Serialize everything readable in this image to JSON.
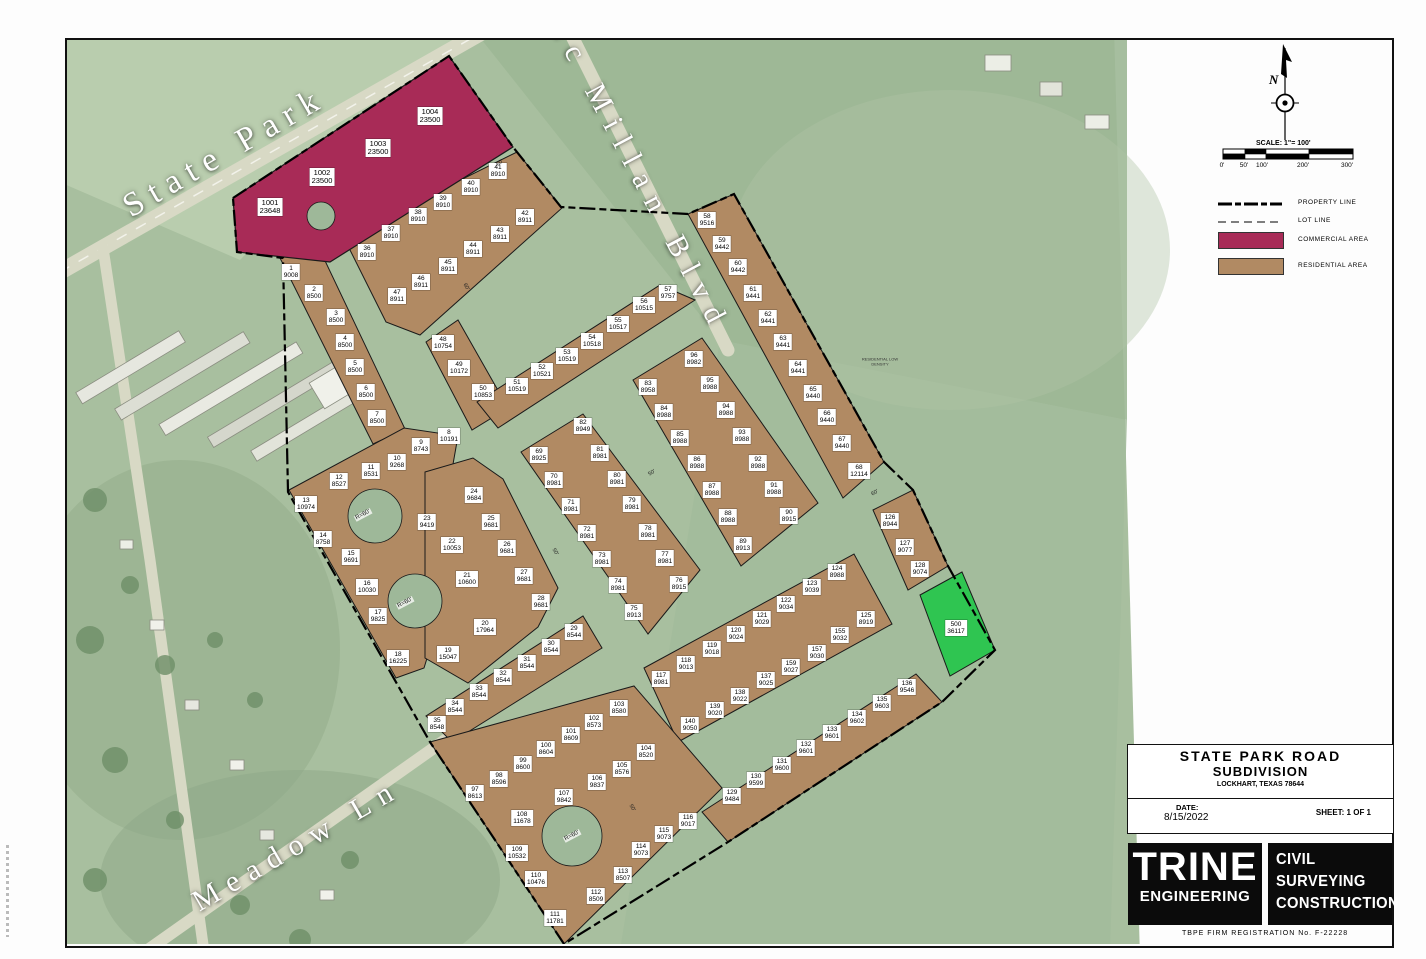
{
  "title_block": {
    "line1": "STATE PARK ROAD",
    "line2": "SUBDIVISION",
    "line3": "LOCKHART, TEXAS 78644",
    "date_label": "DATE:",
    "date": "8/15/2022",
    "sheet": "SHEET: 1 OF 1",
    "firm_name": "TRINE",
    "firm_sub": "ENGINEERING",
    "services": [
      "CIVIL",
      "SURVEYING",
      "CONSTRUCTION"
    ],
    "tbpe": "TBPE FIRM REGISTRATION No. F-22228"
  },
  "legend": {
    "north": "N",
    "scale_label": "SCALE: 1\"= 100'",
    "ticks": [
      "0'",
      "50'",
      "100'",
      "200'",
      "300'"
    ],
    "items": [
      {
        "key": "property-line",
        "label": "PROPERTY LINE"
      },
      {
        "key": "lot-line",
        "label": "LOT LINE"
      },
      {
        "key": "commercial",
        "label": "COMMERCIAL AREA"
      },
      {
        "key": "residential",
        "label": "RESIDENTIAL AREA"
      }
    ]
  },
  "streets": [
    {
      "name": "State Park"
    },
    {
      "name": "Mc Millan Blvd"
    },
    {
      "name": "Meadow Ln"
    }
  ],
  "colors": {
    "commercial": "#a82b57",
    "residential": "#b18a63",
    "green": "#2fc551",
    "street": "#9eb899",
    "aerial": "#a8bf9f",
    "road": "#d8d9c5"
  },
  "annotation": "RESIDENTIAL LOW DENSITY",
  "lots": {
    "commercial": [
      {
        "n": "1001",
        "a": "23648",
        "x": 270,
        "y": 207
      },
      {
        "n": "1002",
        "a": "23500",
        "x": 322,
        "y": 177
      },
      {
        "n": "1003",
        "a": "23500",
        "x": 378,
        "y": 148
      },
      {
        "n": "1004",
        "a": "23500",
        "x": 430,
        "y": 116
      }
    ],
    "green": [
      {
        "n": "500",
        "a": "36117",
        "x": 956,
        "y": 628
      }
    ],
    "residential": [
      {
        "n": "1",
        "a": "9008",
        "x": 291,
        "y": 272
      },
      {
        "n": "2",
        "a": "8500",
        "x": 314,
        "y": 293
      },
      {
        "n": "3",
        "a": "8500",
        "x": 336,
        "y": 317
      },
      {
        "n": "4",
        "a": "8500",
        "x": 345,
        "y": 342
      },
      {
        "n": "5",
        "a": "8500",
        "x": 355,
        "y": 367
      },
      {
        "n": "6",
        "a": "8500",
        "x": 366,
        "y": 392
      },
      {
        "n": "7",
        "a": "8500",
        "x": 377,
        "y": 418
      },
      {
        "n": "8",
        "a": "10191",
        "x": 449,
        "y": 436
      },
      {
        "n": "9",
        "a": "8743",
        "x": 421,
        "y": 446
      },
      {
        "n": "10",
        "a": "9268",
        "x": 397,
        "y": 462
      },
      {
        "n": "11",
        "a": "8531",
        "x": 371,
        "y": 471
      },
      {
        "n": "12",
        "a": "8527",
        "x": 339,
        "y": 481
      },
      {
        "n": "13",
        "a": "10974",
        "x": 306,
        "y": 504
      },
      {
        "n": "14",
        "a": "8758",
        "x": 323,
        "y": 539
      },
      {
        "n": "15",
        "a": "9691",
        "x": 351,
        "y": 557
      },
      {
        "n": "16",
        "a": "10030",
        "x": 367,
        "y": 587
      },
      {
        "n": "17",
        "a": "9825",
        "x": 378,
        "y": 616
      },
      {
        "n": "18",
        "a": "16225",
        "x": 398,
        "y": 658
      },
      {
        "n": "19",
        "a": "15047",
        "x": 448,
        "y": 654
      },
      {
        "n": "20",
        "a": "17964",
        "x": 485,
        "y": 627
      },
      {
        "n": "21",
        "a": "10600",
        "x": 467,
        "y": 579
      },
      {
        "n": "22",
        "a": "10053",
        "x": 452,
        "y": 545
      },
      {
        "n": "23",
        "a": "9419",
        "x": 427,
        "y": 522
      },
      {
        "n": "24",
        "a": "9684",
        "x": 474,
        "y": 495
      },
      {
        "n": "25",
        "a": "9681",
        "x": 491,
        "y": 522
      },
      {
        "n": "26",
        "a": "9681",
        "x": 507,
        "y": 548
      },
      {
        "n": "27",
        "a": "9681",
        "x": 524,
        "y": 576
      },
      {
        "n": "28",
        "a": "9681",
        "x": 541,
        "y": 602
      },
      {
        "n": "29",
        "a": "8544",
        "x": 574,
        "y": 632
      },
      {
        "n": "30",
        "a": "8544",
        "x": 551,
        "y": 647
      },
      {
        "n": "31",
        "a": "8544",
        "x": 527,
        "y": 663
      },
      {
        "n": "32",
        "a": "8544",
        "x": 503,
        "y": 677
      },
      {
        "n": "33",
        "a": "8544",
        "x": 479,
        "y": 692
      },
      {
        "n": "34",
        "a": "8544",
        "x": 455,
        "y": 707
      },
      {
        "n": "35",
        "a": "8548",
        "x": 437,
        "y": 724
      },
      {
        "n": "36",
        "a": "8910",
        "x": 367,
        "y": 252
      },
      {
        "n": "37",
        "a": "8910",
        "x": 391,
        "y": 233
      },
      {
        "n": "38",
        "a": "8910",
        "x": 418,
        "y": 216
      },
      {
        "n": "39",
        "a": "8910",
        "x": 443,
        "y": 202
      },
      {
        "n": "40",
        "a": "8910",
        "x": 471,
        "y": 187
      },
      {
        "n": "41",
        "a": "8910",
        "x": 498,
        "y": 171
      },
      {
        "n": "42",
        "a": "8911",
        "x": 525,
        "y": 217
      },
      {
        "n": "43",
        "a": "8911",
        "x": 500,
        "y": 234
      },
      {
        "n": "44",
        "a": "8911",
        "x": 473,
        "y": 249
      },
      {
        "n": "45",
        "a": "8911",
        "x": 448,
        "y": 266
      },
      {
        "n": "46",
        "a": "8911",
        "x": 421,
        "y": 282
      },
      {
        "n": "47",
        "a": "8911",
        "x": 397,
        "y": 296
      },
      {
        "n": "48",
        "a": "10754",
        "x": 443,
        "y": 343
      },
      {
        "n": "49",
        "a": "10172",
        "x": 459,
        "y": 368
      },
      {
        "n": "50",
        "a": "10853",
        "x": 483,
        "y": 392
      },
      {
        "n": "51",
        "a": "10519",
        "x": 517,
        "y": 386
      },
      {
        "n": "52",
        "a": "10521",
        "x": 542,
        "y": 371
      },
      {
        "n": "53",
        "a": "10519",
        "x": 567,
        "y": 356
      },
      {
        "n": "54",
        "a": "10518",
        "x": 592,
        "y": 341
      },
      {
        "n": "55",
        "a": "10517",
        "x": 618,
        "y": 324
      },
      {
        "n": "56",
        "a": "10515",
        "x": 644,
        "y": 305
      },
      {
        "n": "57",
        "a": "9757",
        "x": 668,
        "y": 293
      },
      {
        "n": "58",
        "a": "9516",
        "x": 707,
        "y": 220
      },
      {
        "n": "59",
        "a": "9442",
        "x": 722,
        "y": 244
      },
      {
        "n": "60",
        "a": "9442",
        "x": 738,
        "y": 267
      },
      {
        "n": "61",
        "a": "9441",
        "x": 753,
        "y": 293
      },
      {
        "n": "62",
        "a": "9441",
        "x": 768,
        "y": 318
      },
      {
        "n": "63",
        "a": "9441",
        "x": 783,
        "y": 342
      },
      {
        "n": "64",
        "a": "9441",
        "x": 798,
        "y": 368
      },
      {
        "n": "65",
        "a": "9440",
        "x": 813,
        "y": 393
      },
      {
        "n": "66",
        "a": "9440",
        "x": 827,
        "y": 417
      },
      {
        "n": "67",
        "a": "9440",
        "x": 842,
        "y": 443
      },
      {
        "n": "68",
        "a": "12114",
        "x": 859,
        "y": 471
      },
      {
        "n": "69",
        "a": "8925",
        "x": 539,
        "y": 455
      },
      {
        "n": "70",
        "a": "8981",
        "x": 554,
        "y": 480
      },
      {
        "n": "71",
        "a": "8981",
        "x": 571,
        "y": 506
      },
      {
        "n": "72",
        "a": "8981",
        "x": 587,
        "y": 533
      },
      {
        "n": "73",
        "a": "8981",
        "x": 602,
        "y": 559
      },
      {
        "n": "74",
        "a": "8981",
        "x": 618,
        "y": 585
      },
      {
        "n": "75",
        "a": "8913",
        "x": 634,
        "y": 612
      },
      {
        "n": "76",
        "a": "8915",
        "x": 679,
        "y": 584
      },
      {
        "n": "77",
        "a": "8981",
        "x": 665,
        "y": 558
      },
      {
        "n": "78",
        "a": "8981",
        "x": 648,
        "y": 532
      },
      {
        "n": "79",
        "a": "8981",
        "x": 632,
        "y": 504
      },
      {
        "n": "80",
        "a": "8981",
        "x": 617,
        "y": 479
      },
      {
        "n": "81",
        "a": "8981",
        "x": 600,
        "y": 453
      },
      {
        "n": "82",
        "a": "8949",
        "x": 583,
        "y": 426
      },
      {
        "n": "83",
        "a": "8958",
        "x": 648,
        "y": 387
      },
      {
        "n": "84",
        "a": "8988",
        "x": 664,
        "y": 412
      },
      {
        "n": "85",
        "a": "8988",
        "x": 680,
        "y": 438
      },
      {
        "n": "86",
        "a": "8988",
        "x": 697,
        "y": 463
      },
      {
        "n": "87",
        "a": "8988",
        "x": 712,
        "y": 490
      },
      {
        "n": "88",
        "a": "8988",
        "x": 728,
        "y": 517
      },
      {
        "n": "89",
        "a": "8913",
        "x": 743,
        "y": 545
      },
      {
        "n": "90",
        "a": "8915",
        "x": 789,
        "y": 516
      },
      {
        "n": "91",
        "a": "8988",
        "x": 774,
        "y": 489
      },
      {
        "n": "92",
        "a": "8988",
        "x": 758,
        "y": 463
      },
      {
        "n": "93",
        "a": "8988",
        "x": 742,
        "y": 436
      },
      {
        "n": "94",
        "a": "8988",
        "x": 726,
        "y": 410
      },
      {
        "n": "95",
        "a": "8988",
        "x": 710,
        "y": 384
      },
      {
        "n": "96",
        "a": "8982",
        "x": 694,
        "y": 359
      },
      {
        "n": "97",
        "a": "8613",
        "x": 475,
        "y": 793
      },
      {
        "n": "98",
        "a": "8596",
        "x": 499,
        "y": 779
      },
      {
        "n": "99",
        "a": "8600",
        "x": 523,
        "y": 764
      },
      {
        "n": "100",
        "a": "8604",
        "x": 546,
        "y": 749
      },
      {
        "n": "101",
        "a": "8609",
        "x": 571,
        "y": 735
      },
      {
        "n": "102",
        "a": "8573",
        "x": 594,
        "y": 722
      },
      {
        "n": "103",
        "a": "8580",
        "x": 619,
        "y": 708
      },
      {
        "n": "104",
        "a": "8520",
        "x": 646,
        "y": 752
      },
      {
        "n": "105",
        "a": "8576",
        "x": 622,
        "y": 769
      },
      {
        "n": "106",
        "a": "9837",
        "x": 597,
        "y": 782
      },
      {
        "n": "107",
        "a": "9842",
        "x": 564,
        "y": 797
      },
      {
        "n": "108",
        "a": "11678",
        "x": 522,
        "y": 818
      },
      {
        "n": "109",
        "a": "10532",
        "x": 517,
        "y": 853
      },
      {
        "n": "110",
        "a": "10476",
        "x": 536,
        "y": 879
      },
      {
        "n": "111",
        "a": "11781",
        "x": 555,
        "y": 918
      },
      {
        "n": "112",
        "a": "8509",
        "x": 596,
        "y": 896
      },
      {
        "n": "113",
        "a": "8507",
        "x": 623,
        "y": 875
      },
      {
        "n": "114",
        "a": "9073",
        "x": 641,
        "y": 850
      },
      {
        "n": "115",
        "a": "9073",
        "x": 664,
        "y": 834
      },
      {
        "n": "116",
        "a": "9017",
        "x": 688,
        "y": 821
      },
      {
        "n": "117",
        "a": "8981",
        "x": 661,
        "y": 679
      },
      {
        "n": "118",
        "a": "9013",
        "x": 686,
        "y": 664
      },
      {
        "n": "119",
        "a": "9018",
        "x": 712,
        "y": 649
      },
      {
        "n": "120",
        "a": "9024",
        "x": 736,
        "y": 634
      },
      {
        "n": "121",
        "a": "9029",
        "x": 762,
        "y": 619
      },
      {
        "n": "122",
        "a": "9034",
        "x": 786,
        "y": 604
      },
      {
        "n": "123",
        "a": "9039",
        "x": 812,
        "y": 587
      },
      {
        "n": "124",
        "a": "8988",
        "x": 837,
        "y": 572
      },
      {
        "n": "125",
        "a": "8919",
        "x": 866,
        "y": 619
      },
      {
        "n": "126",
        "a": "8944",
        "x": 890,
        "y": 521
      },
      {
        "n": "127",
        "a": "9077",
        "x": 905,
        "y": 547
      },
      {
        "n": "128",
        "a": "9074",
        "x": 920,
        "y": 569
      },
      {
        "n": "129",
        "a": "9484",
        "x": 732,
        "y": 796
      },
      {
        "n": "130",
        "a": "9599",
        "x": 756,
        "y": 780
      },
      {
        "n": "131",
        "a": "9600",
        "x": 782,
        "y": 765
      },
      {
        "n": "132",
        "a": "9601",
        "x": 806,
        "y": 748
      },
      {
        "n": "133",
        "a": "9601",
        "x": 832,
        "y": 733
      },
      {
        "n": "134",
        "a": "9602",
        "x": 857,
        "y": 718
      },
      {
        "n": "135",
        "a": "9603",
        "x": 882,
        "y": 703
      },
      {
        "n": "136",
        "a": "9546",
        "x": 907,
        "y": 687
      },
      {
        "n": "137",
        "a": "9025",
        "x": 766,
        "y": 680
      },
      {
        "n": "138",
        "a": "9022",
        "x": 740,
        "y": 696
      },
      {
        "n": "139",
        "a": "9020",
        "x": 715,
        "y": 710
      },
      {
        "n": "140",
        "a": "9050",
        "x": 690,
        "y": 725
      },
      {
        "n": "155",
        "a": "9032",
        "x": 840,
        "y": 635
      },
      {
        "n": "157",
        "a": "9030",
        "x": 817,
        "y": 653
      },
      {
        "n": "159",
        "a": "9027",
        "x": 791,
        "y": 667
      }
    ],
    "radius_labels": [
      {
        "t": "R=60'",
        "x": 363,
        "y": 515
      },
      {
        "t": "R=60'",
        "x": 405,
        "y": 603
      },
      {
        "t": "R=60'",
        "x": 572,
        "y": 836
      }
    ],
    "dim_labels": [
      {
        "t": "60'",
        "x": 500,
        "y": 163,
        "r": -35
      },
      {
        "t": "60'",
        "x": 466,
        "y": 287,
        "r": 57
      },
      {
        "t": "50'",
        "x": 555,
        "y": 552,
        "r": 57
      },
      {
        "t": "50'",
        "x": 652,
        "y": 473,
        "r": -33
      },
      {
        "t": "60'",
        "x": 875,
        "y": 493,
        "r": -33
      },
      {
        "t": "50'",
        "x": 632,
        "y": 808,
        "r": 57
      }
    ]
  }
}
